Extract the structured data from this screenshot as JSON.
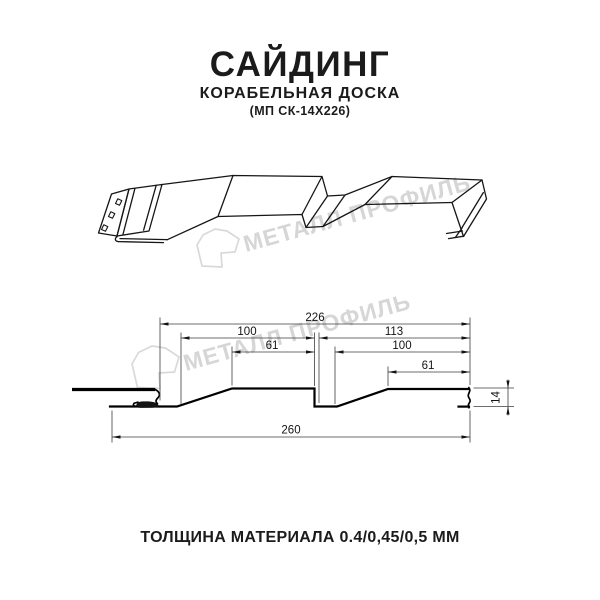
{
  "header": {
    "title": "САЙДИНГ",
    "subtitle": "КОРАБЕЛЬНАЯ ДОСКА",
    "model": "(МП СК-14Х226)"
  },
  "watermark": {
    "text": "МЕТАЛЛ ПРОФИЛЬ",
    "logo": "metall-profil-house-logo",
    "color": "#d6d6d6"
  },
  "dims": {
    "module_width": "226",
    "board1_pitch": "100",
    "board2_span": "113",
    "board1_flat": "61",
    "board2_pitch": "100",
    "board2_flat": "61",
    "total_width": "260",
    "profile_height": "14"
  },
  "footer": {
    "thickness": "ТОЛЩИНА МАТЕРИАЛА 0.4/0,45/0,5 ММ"
  }
}
